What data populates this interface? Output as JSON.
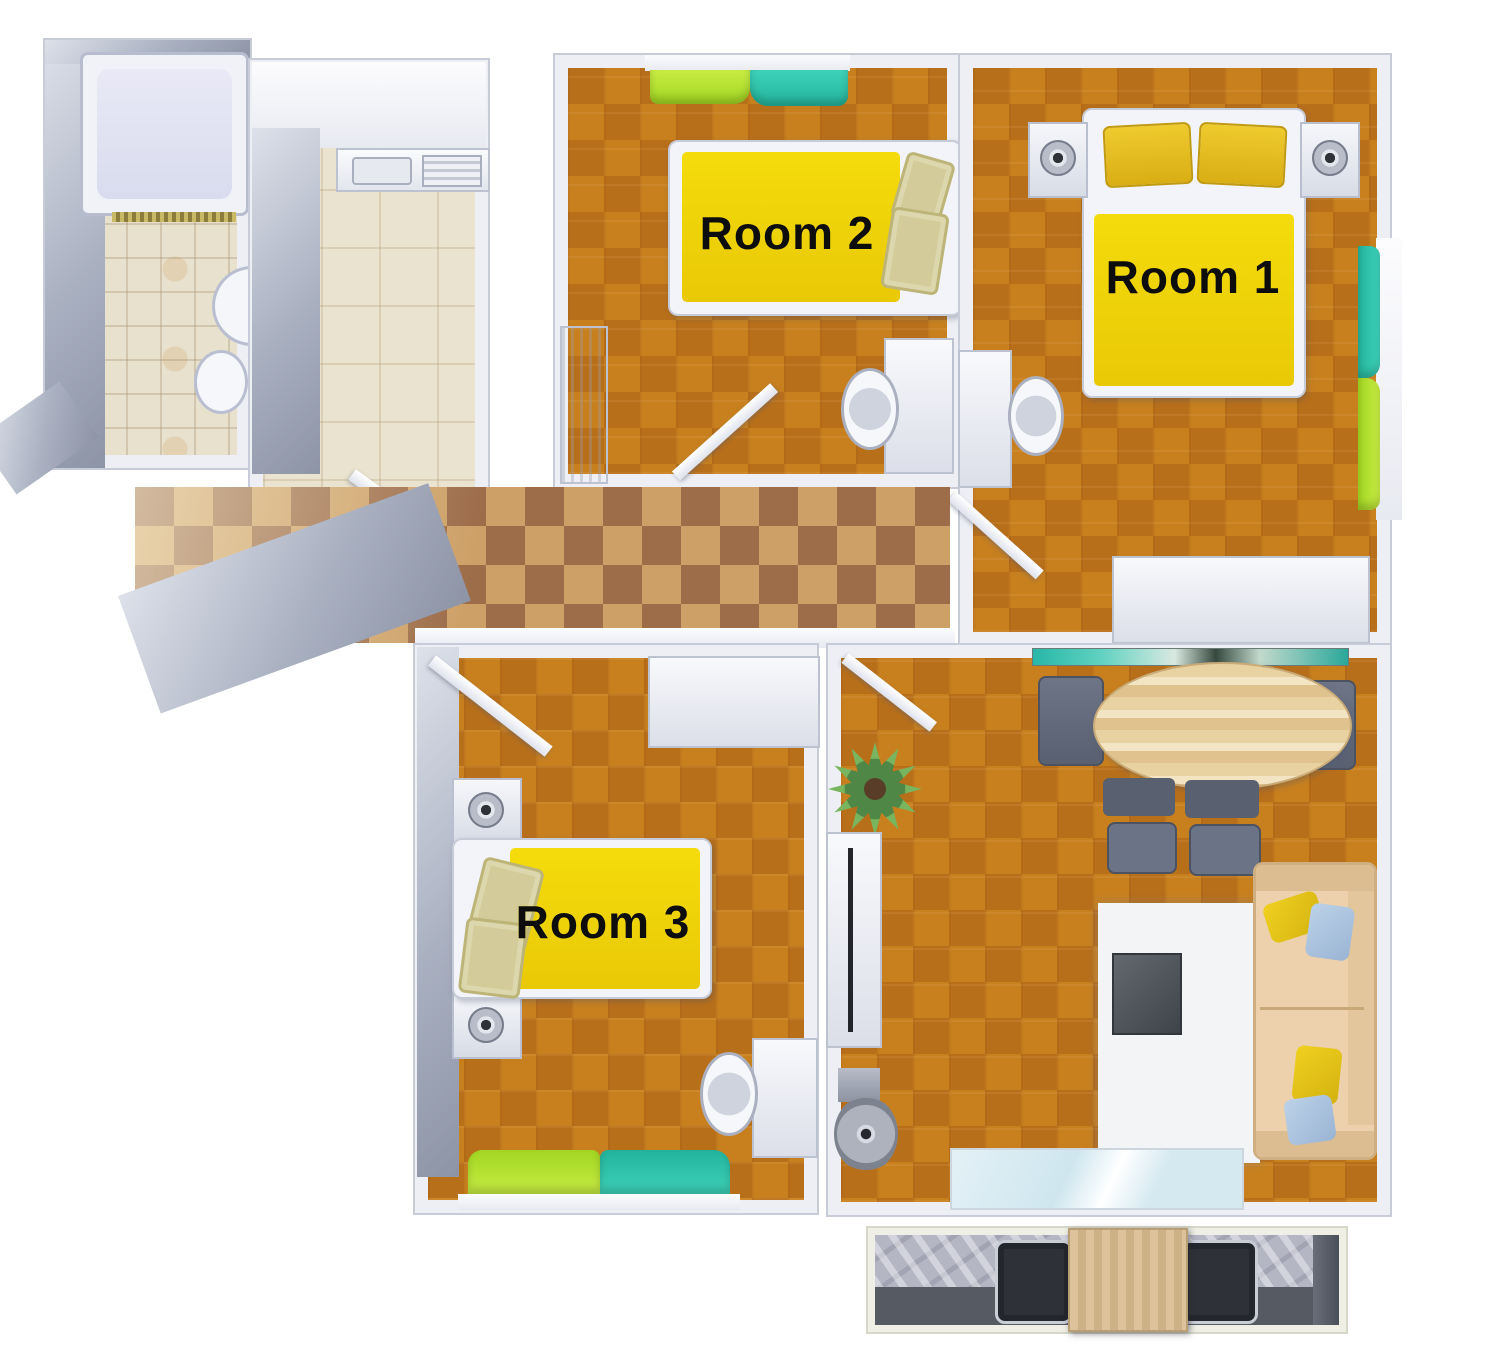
{
  "plan": {
    "room1_label": "Room 1",
    "room2_label": "Room 2",
    "room3_label": "Room 3"
  },
  "palette": {
    "bed_yellow": "#F0D60E",
    "carpet_orange": "#C1761C",
    "hall_tile_light": "#CDA067",
    "hall_tile_dark": "#9D6C49",
    "bath_tile_beige": "#E8E1CE",
    "curtain_green": "#A9DC33",
    "curtain_teal": "#2FC3AC",
    "pillow_khaki": "#D3CC9A",
    "pillow_yellow": "#E5C328",
    "pillow_blue": "#A9C4DF",
    "sofa_beige": "#ECD1AC",
    "wall_grey": "#A9B0C0",
    "rug_white": "#F3F4F6",
    "balcony_marble": "#B4B6C4",
    "label_text": "#0D0D0D"
  }
}
